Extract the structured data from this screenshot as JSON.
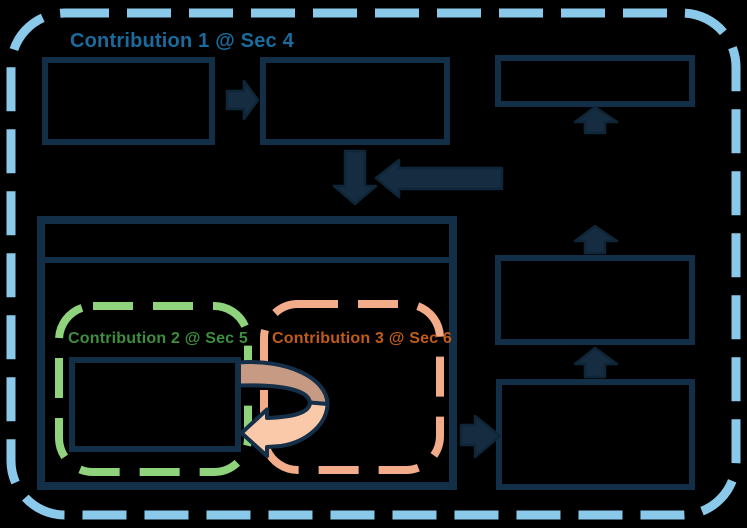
{
  "diagram": {
    "title_group": {
      "label": "Contribution 1 @ Sec 4",
      "text_color": "#1a6b9d",
      "border_color": "#8bc9ea",
      "border_style": "dashed-rounded"
    },
    "inner_groups": [
      {
        "label": "Contribution 2 @ Sec 5",
        "text_color": "#3e8e3e",
        "border_color": "#8fd37d",
        "border_style": "dashed-rounded"
      },
      {
        "label": "Contribution 3 @ Sec 6",
        "text_color": "#c05c17",
        "border_color": "#f2ac8a",
        "border_style": "dashed-rounded"
      }
    ],
    "colors": {
      "background": "#000000",
      "box_outline": "#132f47",
      "arrow_fill": "#152c41",
      "curved_arrow_top": "#c79b83",
      "curved_arrow_bottom": "#f9c9a9"
    },
    "shapes": {
      "boxes_empty_count": 7,
      "straight_arrows_count": 7,
      "curved_arrows_count": 1
    }
  }
}
